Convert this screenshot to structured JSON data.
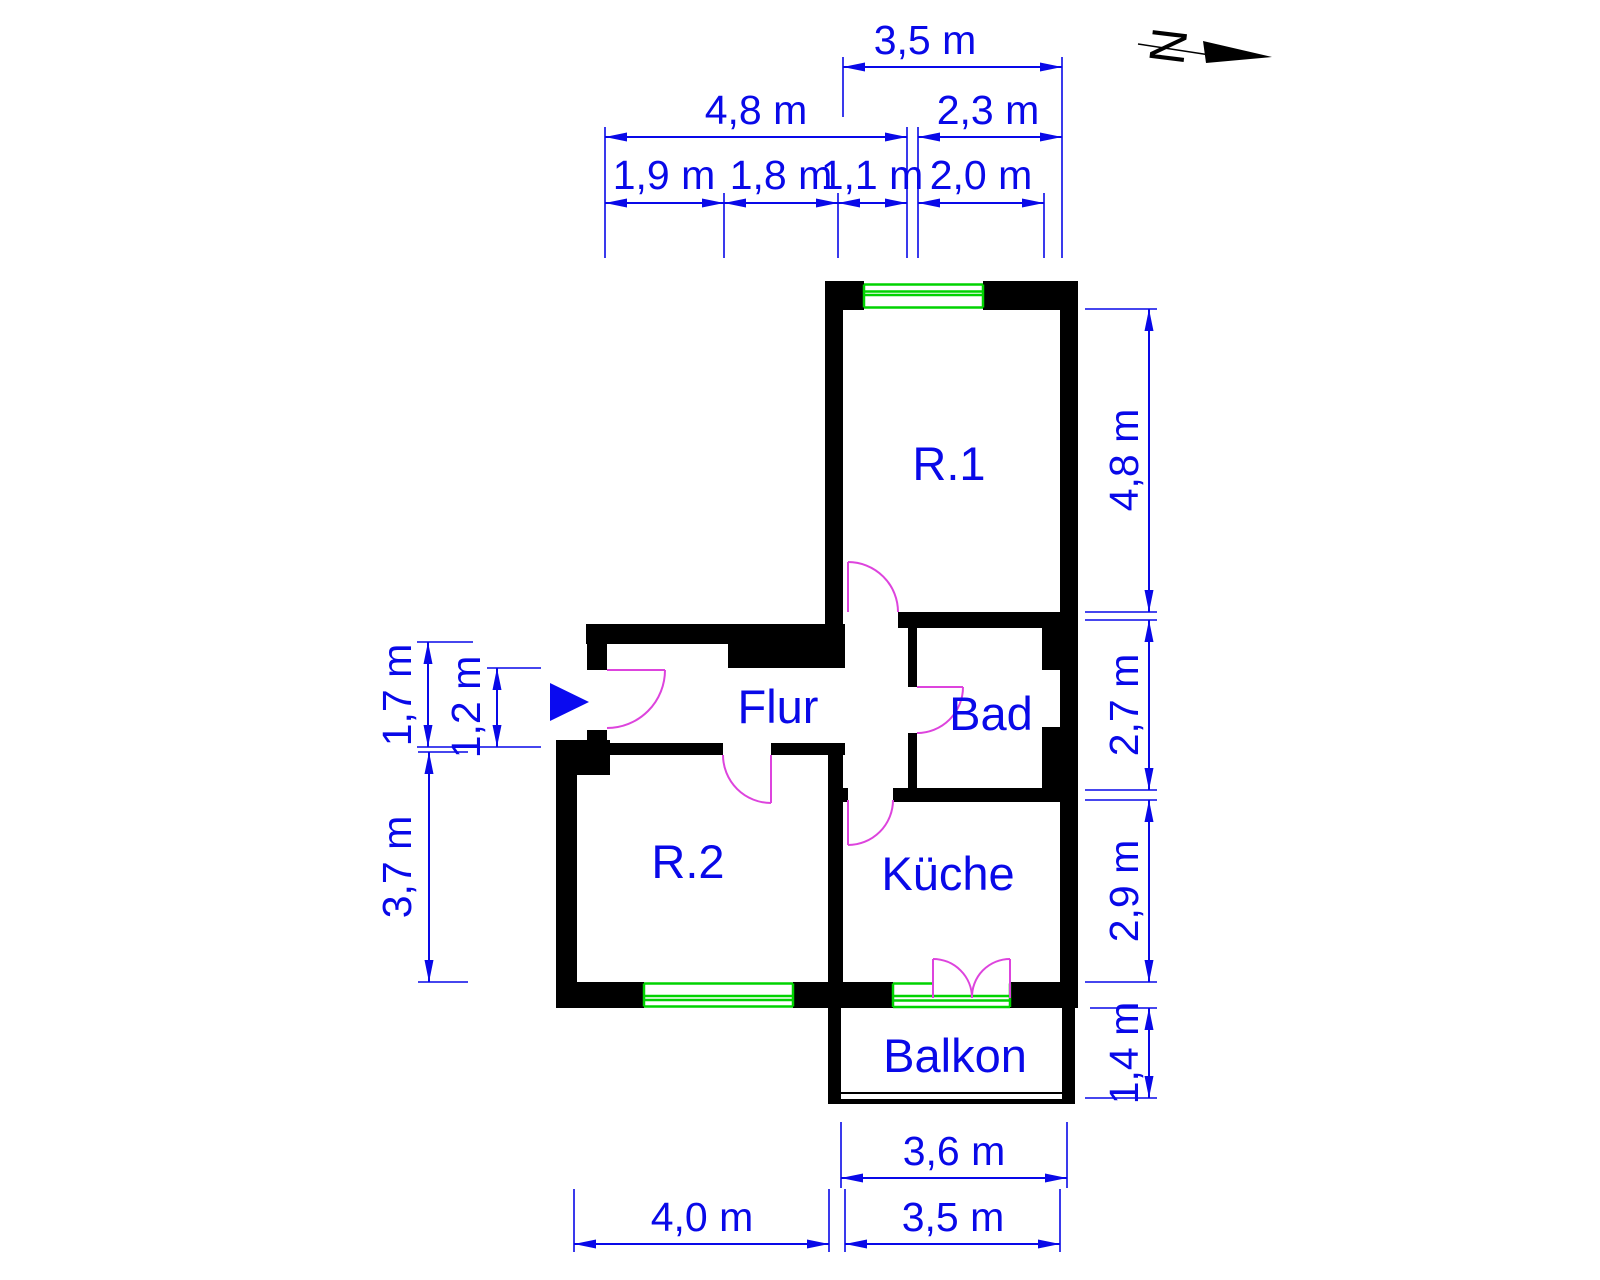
{
  "north": {
    "label": "N"
  },
  "rooms": {
    "r1": "R.1",
    "flur": "Flur",
    "bad": "Bad",
    "r2": "R.2",
    "kueche": "Küche",
    "balkon": "Balkon"
  },
  "dims": {
    "top_row1": [
      "3,5 m"
    ],
    "top_row2": [
      "4,8 m",
      "2,3 m"
    ],
    "top_row3": [
      "1,9 m",
      "1,8 m",
      "1,1 m",
      "2,0 m"
    ],
    "right": [
      "4,8 m",
      "2,7 m",
      "2,9 m",
      "1,4 m"
    ],
    "left": [
      "1,7 m",
      "1,2 m",
      "3,7 m"
    ],
    "bottom_row1": [
      "3,6 m"
    ],
    "bottom_row2": [
      "4,0 m",
      "3,5 m"
    ]
  },
  "colors": {
    "dimension": "#0909e8",
    "room_label": "#0909e8",
    "wall": "#000000",
    "door": "#dd44dd",
    "window": "#00d300",
    "entry_arrow": "#0a0af0",
    "north_symbol": "#000000"
  }
}
